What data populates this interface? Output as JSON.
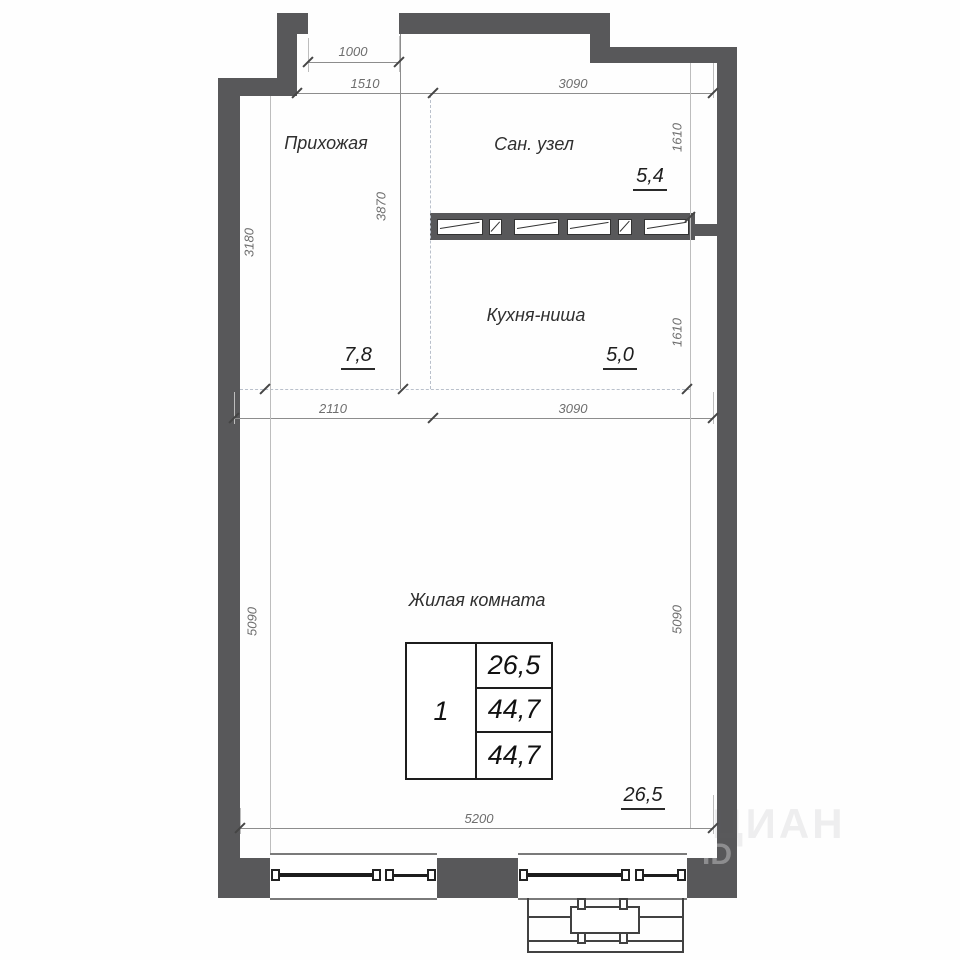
{
  "rooms": {
    "hallway": {
      "label": "Прихожая",
      "area": "7,8"
    },
    "bathroom": {
      "label": "Сан. узел",
      "area": "5,4"
    },
    "kitchen": {
      "label": "Кухня-ниша",
      "area": "5,0"
    },
    "living": {
      "label": "Жилая комната",
      "area": "26,5"
    }
  },
  "dimensions": {
    "entry_opening": "1000",
    "hallway_width": "1510",
    "top_width": "3090",
    "hallway_depth": "3180",
    "hallway_length": "3870",
    "bathroom_depth": "1610",
    "kitchen_depth": "1610",
    "living_width_left": "2110",
    "living_width_right": "3090",
    "living_depth_left": "5090",
    "living_depth_right": "5090",
    "living_width_bottom": "5200"
  },
  "info_table": {
    "rooms_count": "1",
    "values": [
      "26,5",
      "44,7",
      "44,7"
    ]
  },
  "watermark": {
    "word": "ЦИАН",
    "badge": "ID"
  },
  "colors": {
    "wall": "#58585a",
    "dimension_text": "#6e6e6e",
    "dashed_line": "#b9c0cb",
    "label_text": "#2f2f2f"
  }
}
